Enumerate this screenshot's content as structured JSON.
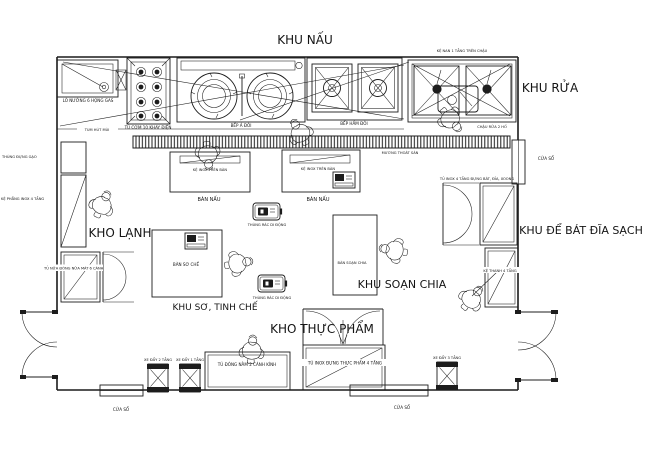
{
  "plan": {
    "title": "KHU NẤU",
    "areas": {
      "khu_rua": "KHU RỬA",
      "kho_lanh": "KHO LẠNH",
      "khu_de_bat_dia_sach": "KHU ĐỂ BÁT ĐĨA SẠCH",
      "khu_so_tinh_che": "KHU SƠ, TINH CHẾ",
      "khu_soan_chia": "KHU SOẠN CHIA",
      "kho_thuc_pham": "KHO THỰC PHẨM"
    },
    "labels": {
      "lo_nuong": "LÒ NƯỚNG 6 HỌNG GAS",
      "tu_com": "TỦ CƠM 10 KHAY ĐIỆN",
      "bep_a": "BẾP Á ĐÔI",
      "bep_ham": "BẾP HẦM ĐÔI",
      "ke_nan": "KỆ NAN 1 TẦNG TRÊN CHẬU",
      "chau_rua": "CHẬU RỬA 2 HỐ",
      "tum_hut_mui": "TUM HÚT MÙI",
      "muong_thoat_san": "MƯƠNG THOÁT SÀN",
      "cua_so": "CỬA SỔ",
      "thung_dung_gao": "THÙNG ĐỰNG GẠO",
      "ke_phang": "KỆ PHẲNG INOX 4 TẦNG",
      "tu_nua_dong": "TỦ NỬA ĐÔNG NỬA MÁT 6 CÁNH",
      "ke_inox_tren_ban": "KỆ INOX TRÊN BÀN",
      "ban_nau": "BÀN NẤU",
      "thung_rac": "THÙNG RÁC DI ĐỘNG",
      "ban_so_che": "BÀN SƠ CHẾ",
      "ban_soan_chia": "BÀN SOẠN CHIA",
      "tu_inox_bat_dia": "TỦ INOX 4 TẦNG ĐỰNG BÁT, ĐĨA, XOONG",
      "ke_thanh": "KỆ THANH 4 TẦNG",
      "xe_day_2": "XE ĐẨY 2 TẦNG",
      "xe_day_1": "XE ĐẨY 1 TẦNG",
      "xe_day_3": "XE ĐẨY 3 TẦNG",
      "tu_dong_nam": "TỦ ĐÔNG NẰM 2 CÁNH KÍNH",
      "tu_inox_thuc_pham": "TỦ INOX ĐỰNG THỰC PHẨM 4 TẦNG"
    },
    "colors": {
      "ink": "#1c1c1c",
      "paper": "#ffffff"
    }
  }
}
